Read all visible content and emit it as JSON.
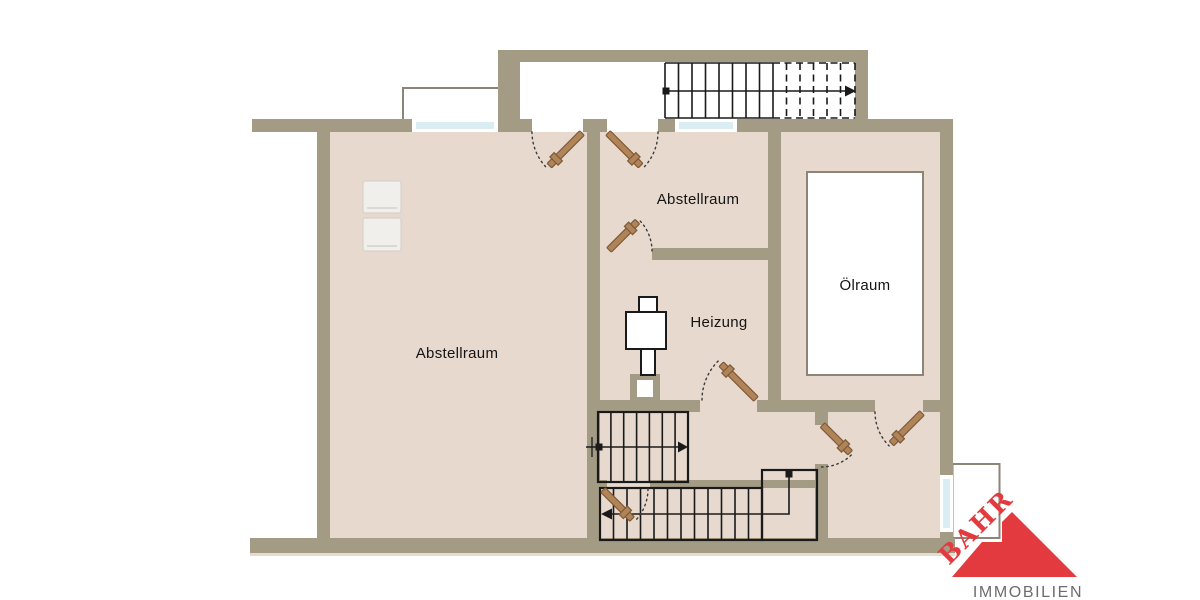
{
  "plan": {
    "type": "floor-plan",
    "rooms": [
      {
        "id": "abstellraum-left",
        "label": "Abstellraum"
      },
      {
        "id": "abstellraum-top",
        "label": "Abstellraum"
      },
      {
        "id": "heizung",
        "label": "Heizung"
      },
      {
        "id": "oelraum",
        "label": "Ölraum"
      }
    ],
    "features": [
      "upper-floor-staircase",
      "interior-staircase",
      "entry-staircase-with-landing",
      "seven-door-swings",
      "three-windows",
      "two-light-wells",
      "furnace-symbol",
      "oil-tank",
      "two-appliances"
    ]
  },
  "logo": {
    "name": "BAHR",
    "tagline": "IMMOBILIEN"
  },
  "colors": {
    "wall": "#a49b84",
    "floor": "#e7d9ce",
    "window-glass": "#d9edf2",
    "outline-thin": "#8d8577",
    "stair-line": "#1a1a1a",
    "door-leaf": "#b18457",
    "door-leaf-edge": "#7d5a3a",
    "label-text": "#141414",
    "appliance-fill": "#f1efec",
    "appliance-edge": "#d6d2cb",
    "logo-red": "#e23a3f",
    "logo-gray": "#6c6b70"
  }
}
